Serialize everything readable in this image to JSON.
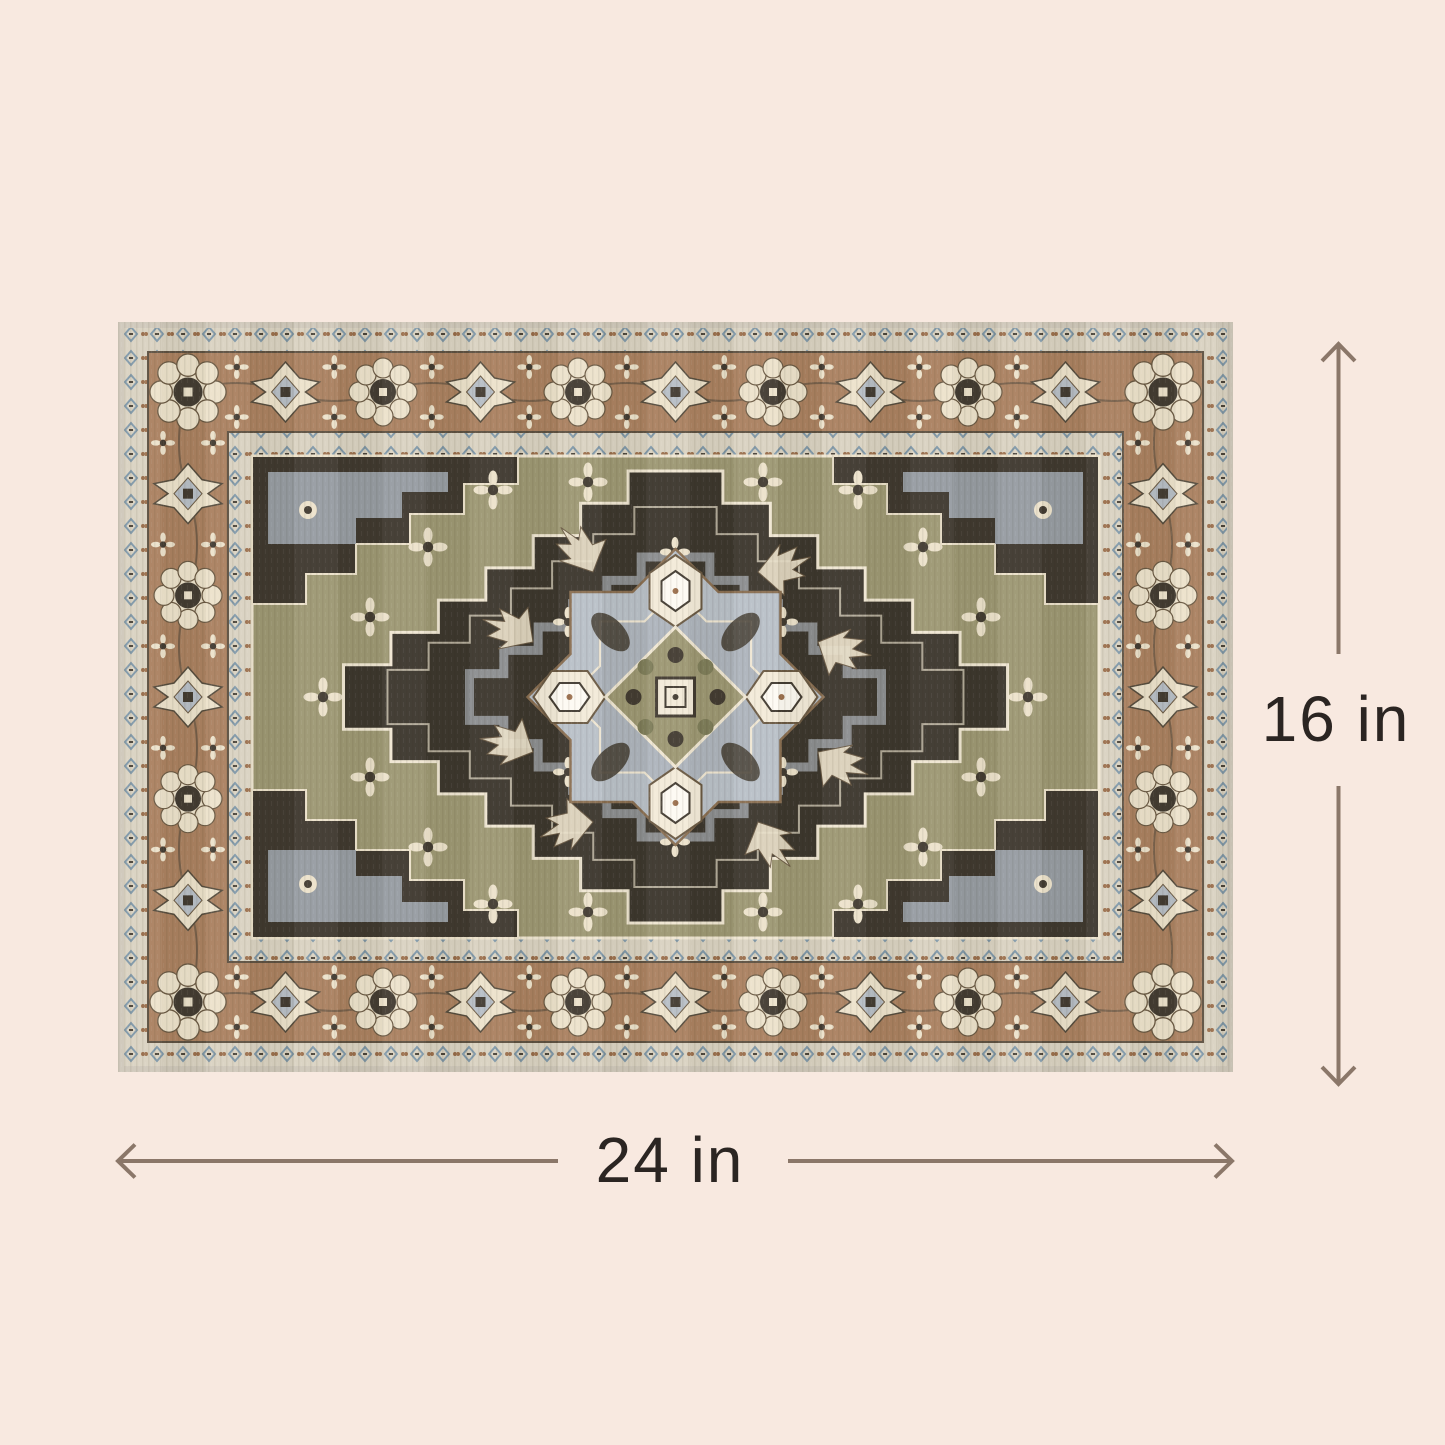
{
  "page": {
    "type": "product-dimension-image",
    "background_color": "#f8e9e0"
  },
  "product_image": {
    "name": "vintage persian medallion area rug",
    "description": "Rectangular oriental rug with brown rosette border, olive green field, dark charcoal stepped center diamond and gray-blue star medallion",
    "colors": {
      "border_brown": "#aa8160",
      "field_olive": "#9d9873",
      "center_charcoal": "#3c362d",
      "motif_cream": "#ece2cb",
      "medallion_gray_blue": "#b7bec6",
      "guard_band": "#d9d2c1",
      "accent_blue": "#7f98a8",
      "accent_rust": "#9b6f4c"
    }
  },
  "dimensions": {
    "height": {
      "label": "16 in",
      "value": 16,
      "unit": "in"
    },
    "width": {
      "label": "24 in",
      "value": 24,
      "unit": "in"
    },
    "line_color": "#8b7769",
    "text_color": "#2b2522"
  }
}
